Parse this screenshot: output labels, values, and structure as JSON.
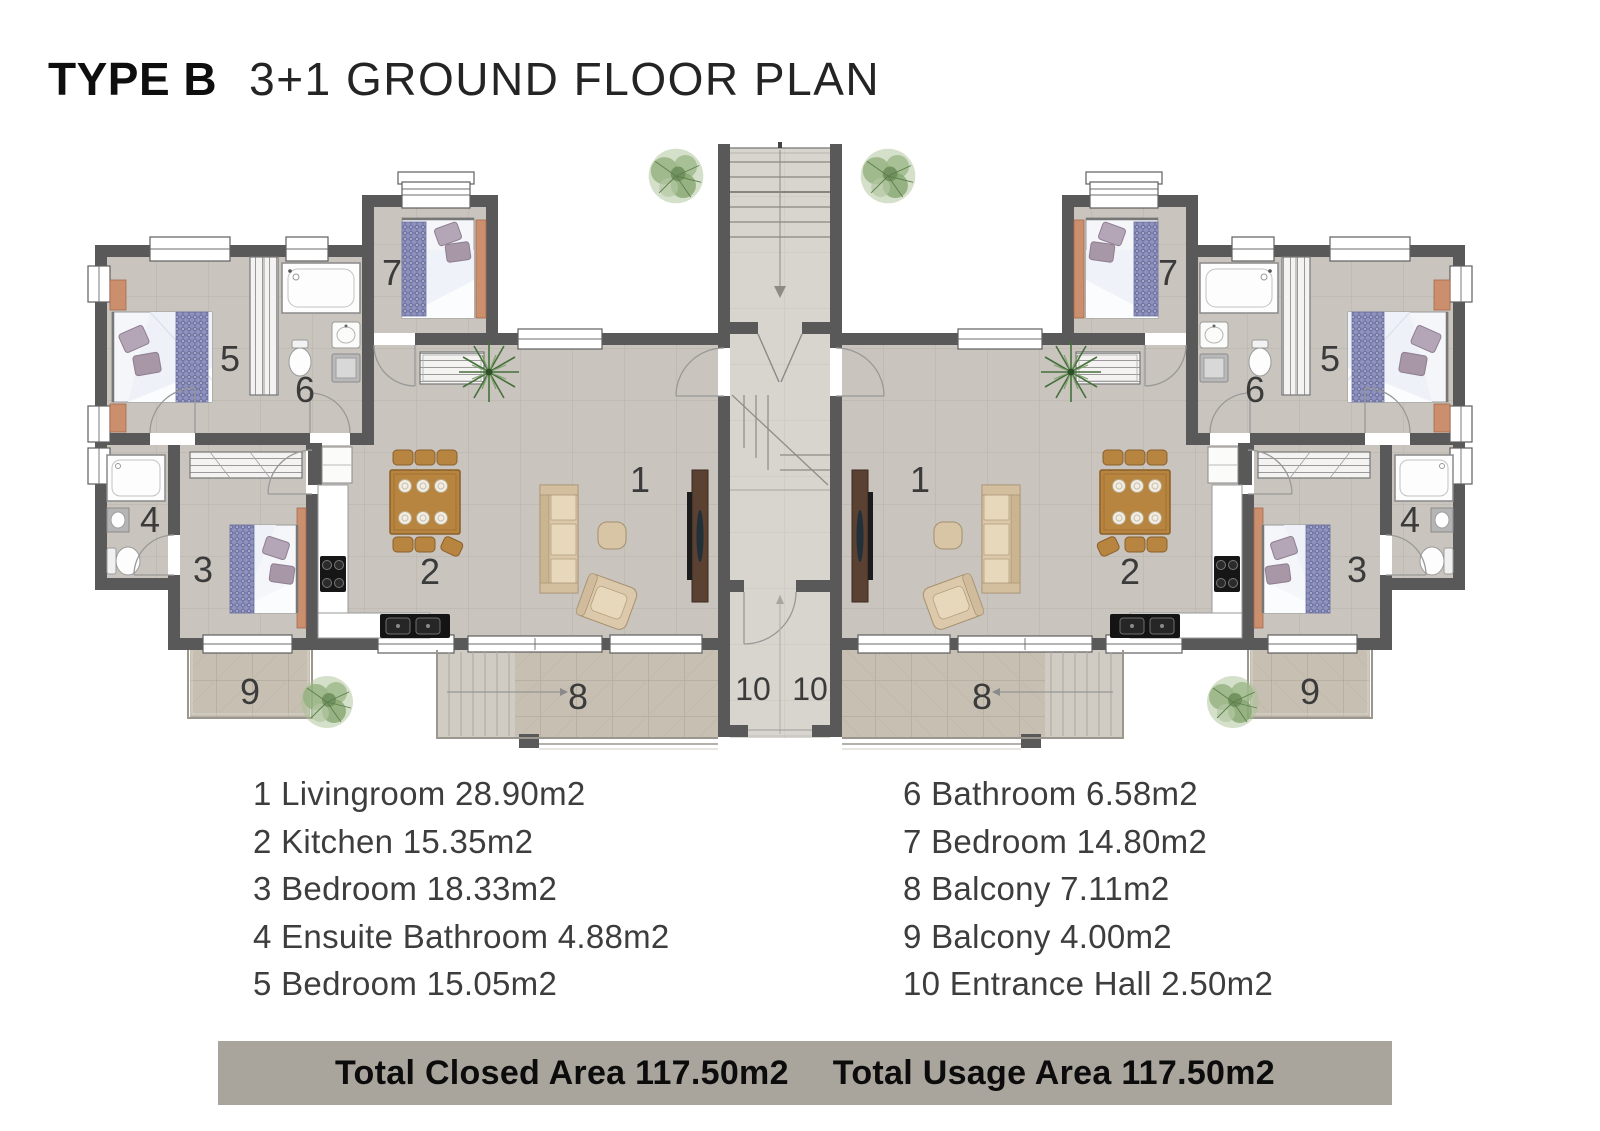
{
  "header": {
    "type_label": "TYPE B",
    "plan_label": "3+1 GROUND FLOOR PLAN"
  },
  "rooms": [
    {
      "id": "1",
      "name": "Livingroom",
      "area": "28.90m2",
      "label": "1 Livingroom 28.90m2"
    },
    {
      "id": "2",
      "name": "Kitchen",
      "area": "15.35m2",
      "label": "2 Kitchen 15.35m2"
    },
    {
      "id": "3",
      "name": "Bedroom",
      "area": "18.33m2",
      "label": "3 Bedroom 18.33m2"
    },
    {
      "id": "4",
      "name": "Ensuite Bathroom",
      "area": "4.88m2",
      "label": "4 Ensuite Bathroom 4.88m2"
    },
    {
      "id": "5",
      "name": "Bedroom",
      "area": "15.05m2",
      "label": "5 Bedroom 15.05m2"
    },
    {
      "id": "6",
      "name": "Bathroom",
      "area": "6.58m2",
      "label": "6 Bathroom 6.58m2"
    },
    {
      "id": "7",
      "name": "Bedroom",
      "area": "14.80m2",
      "label": "7 Bedroom 14.80m2"
    },
    {
      "id": "8",
      "name": "Balcony",
      "area": "7.11m2",
      "label": "8 Balcony 7.11m2"
    },
    {
      "id": "9",
      "name": "Balcony",
      "area": "4.00m2",
      "label": "9 Balcony 4.00m2"
    },
    {
      "id": "10",
      "name": "Entrance Hall",
      "area": "2.50m2",
      "label": "10 Entrance Hall 2.50m2"
    }
  ],
  "totals": {
    "closed": "Total Closed Area 117.50m2",
    "usage": "Total Usage Area 117.50m2"
  },
  "colors": {
    "wall": "#595959",
    "unit_floor": "#c9c5be",
    "hall_floor": "#d8d5ce",
    "balcony_floor": "#c6bfb2",
    "total_bar_bg": "#a9a49c",
    "wood_accent": "#b78540",
    "bed_runner": "#8e91bb",
    "sofa": "#dcc9ab",
    "nightstand": "#cc8f6d",
    "plant": "#92b07e"
  }
}
